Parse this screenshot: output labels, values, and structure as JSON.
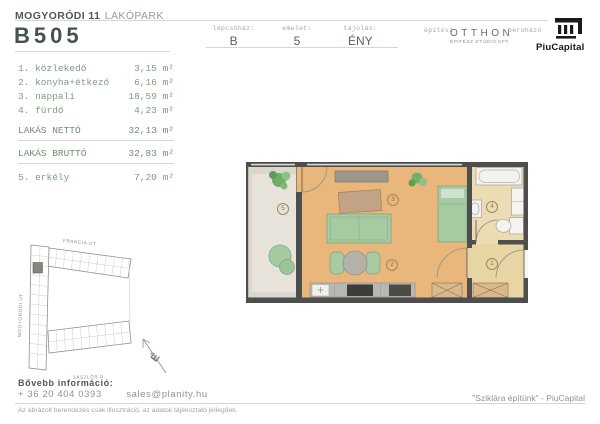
{
  "header": {
    "project": {
      "bold": "MOGYORÓDI 11",
      "light": "LAKÓPARK"
    },
    "unit_id": "B505",
    "fields": [
      {
        "label": "lépcsőház:",
        "value": "B"
      },
      {
        "label": "emelet:",
        "value": "5"
      },
      {
        "label": "tájolás:",
        "value": "ÉNY"
      }
    ],
    "architect": {
      "label": "építész",
      "name": "OTTHON",
      "subtitle": "ÉPÍTÉSZ STÚDIÓ KFT."
    },
    "developer": {
      "label": "beruházó",
      "name": "PiuCapital"
    }
  },
  "room_list": {
    "rooms": [
      {
        "name": "1. közlekedő",
        "value": "3,15 m²"
      },
      {
        "name": "2. konyha+étkező",
        "value": "6,16 m²"
      },
      {
        "name": "3. nappali",
        "value": "18,59 m²"
      },
      {
        "name": "4. fürdő",
        "value": "4,23 m²"
      }
    ],
    "totals": [
      {
        "name": "LAKÁS NETTÓ",
        "value": "32,13 m²"
      },
      {
        "name": "LAKÁS BRUTTÓ",
        "value": "32,83 m²"
      }
    ],
    "balcony": {
      "name": "5. erkély",
      "value": "7,20 m²"
    }
  },
  "floor_plan": {
    "labels": [
      "1",
      "2",
      "3",
      "4",
      "5"
    ]
  },
  "site_plan": {
    "street_top": "FRANCIA ÚT",
    "street_left": "MOGYORÓDI ÚT",
    "street_bottom": "ZÁSZLÓS U.",
    "compass": "É"
  },
  "footer": {
    "info_label": "Bővebb információ:",
    "phone": "+ 36 20 404 0393",
    "email": "sales@planity.hu",
    "disclaimer": "Az ábrázolt berendezés csak illusztráció, az adatok tájékoztató jellegűek.",
    "slogan": "\"Sziklára építünk\" - PiuCapital"
  },
  "colors": {
    "wall": "#4e4e4c",
    "living_floor": "#e9b77c",
    "balcony_floor": "#dcd7ce",
    "bath_floor": "#ecdcb4",
    "entry_floor": "#e8d5a4",
    "furniture_green": "#a6cba2",
    "wood": "#c2a385",
    "highlight_unit": "#85867f"
  }
}
